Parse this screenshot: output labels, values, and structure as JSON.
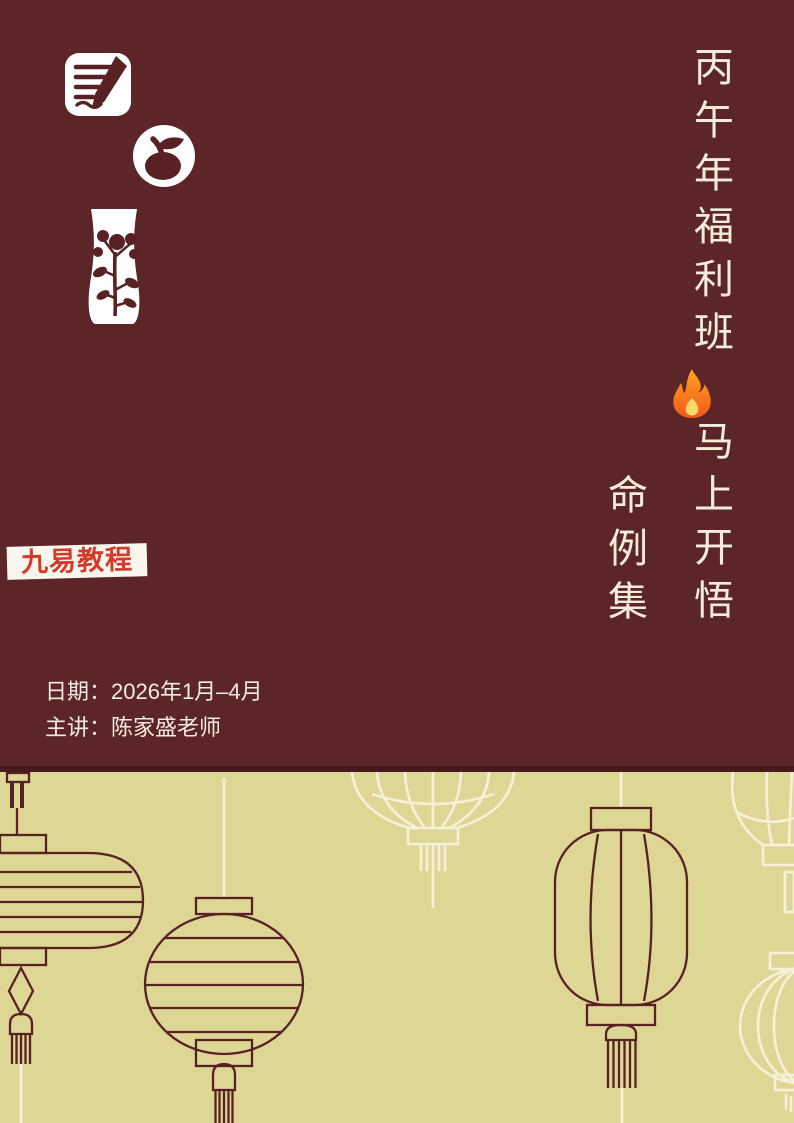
{
  "page": {
    "width": 794,
    "height": 1123
  },
  "colors": {
    "maroon_bg": "#5c2628",
    "divider": "#471a1e",
    "khaki_bg": "#ded695",
    "cream": "#f6f0d6",
    "lantern_stroke": "#582225",
    "title_text": "#f3ecd8",
    "badge_bg": "#f9f6ee",
    "badge_text": "#d23a2c",
    "info_text": "#f2ebe1",
    "flame_orange": "#ff9500",
    "flame_red": "#f4581c",
    "flame_yellow": "#ffd86b"
  },
  "logo_icons": [
    {
      "name": "notepad-pen-icon"
    },
    {
      "name": "fruit-circle-icon"
    },
    {
      "name": "vase-flower-icon"
    }
  ],
  "titles": {
    "main_top": "丙午年福利班",
    "fire_icon": "🔥",
    "main_bottom": "马上开悟",
    "sub": "命例集"
  },
  "badge": {
    "label": "九易教程"
  },
  "info": {
    "date_line": "日期：2026年1月–4月",
    "speaker_line": "主讲：陈家盛老师"
  },
  "banner": {
    "lanterns": [
      "capsule-lantern",
      "round-lantern",
      "palace-lantern",
      "cylinder-lantern",
      "corner-top-lantern",
      "corner-round-lantern"
    ]
  }
}
